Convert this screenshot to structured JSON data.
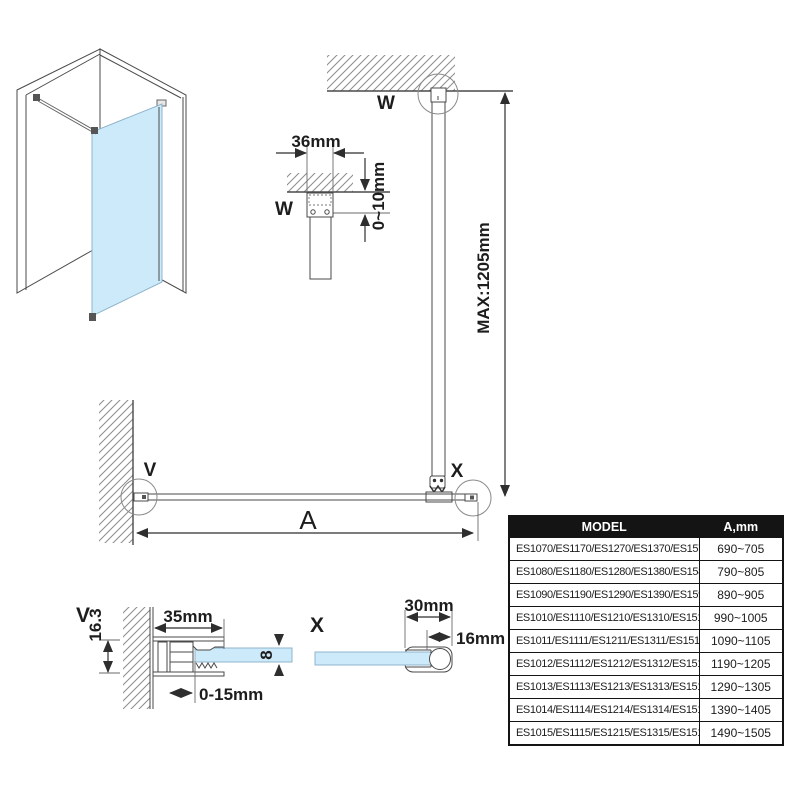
{
  "drawing": {
    "labels": {
      "w_main": "W",
      "w_detail": "W",
      "v_main": "V",
      "v_detail": "V",
      "x_main": "X",
      "x_detail": "X"
    },
    "dims": {
      "bar_to_wall": "36mm",
      "ceiling_adjust": "0~10mm",
      "bar_max_length": "MAX:1205mm",
      "glass_width": "A",
      "profile_depth": "16.3",
      "profile_width": "35mm",
      "side_adjust": "0-15mm",
      "glass_thickness": "8",
      "clamp_length": "30mm",
      "bar_inset": "16mm"
    }
  },
  "table": {
    "header": {
      "model": "MODEL",
      "a": "A,mm"
    },
    "rows": [
      {
        "model": "ES1070/ES1170/ES1270/ES1370/ES1570",
        "a": "690~705"
      },
      {
        "model": "ES1080/ES1180/ES1280/ES1380/ES1580",
        "a": "790~805"
      },
      {
        "model": "ES1090/ES1190/ES1290/ES1390/ES1590",
        "a": "890~905"
      },
      {
        "model": "ES1010/ES1110/ES1210/ES1310/ES1510",
        "a": "990~1005"
      },
      {
        "model": "ES1011/ES1111/ES1211/ES1311/ES1511",
        "a": "1090~1105"
      },
      {
        "model": "ES1012/ES1112/ES1212/ES1312/ES1512",
        "a": "1190~1205"
      },
      {
        "model": "ES1013/ES1113/ES1213/ES1313/ES1513",
        "a": "1290~1305"
      },
      {
        "model": "ES1014/ES1114/ES1214/ES1314/ES1514",
        "a": "1390~1405"
      },
      {
        "model": "ES1015/ES1115/ES1215/ES1315/ES1515",
        "a": "1490~1505"
      }
    ]
  }
}
